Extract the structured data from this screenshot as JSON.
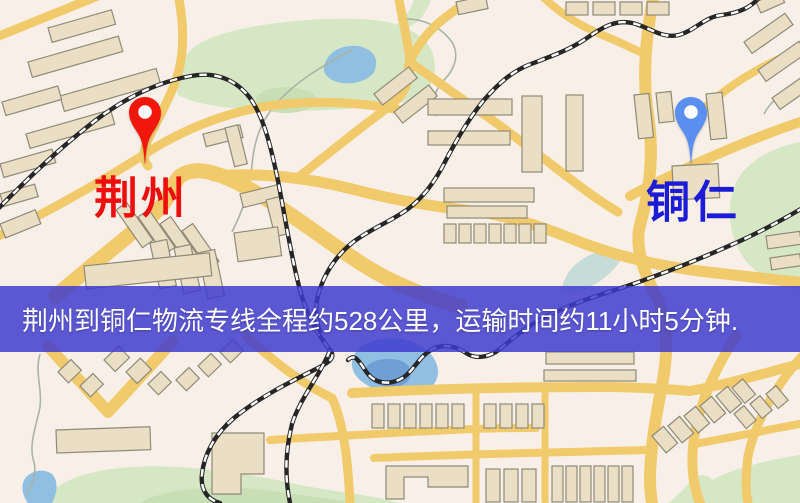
{
  "map": {
    "origin_marker": {
      "city": "荆州",
      "icon": "map-pin-icon",
      "pin_color": "#f2170c",
      "label_color": "#ef0e0e"
    },
    "destination_marker": {
      "city": "铜仁",
      "icon": "map-pin-icon",
      "pin_color": "#5a8ff0",
      "label_color": "#1b1bd8"
    },
    "info_banner": {
      "text": "荆州到铜仁物流专线全程约528公里，运输时间约11小时5分钟.",
      "background_color": "#3e3ace",
      "text_color": "#ffffff"
    },
    "map_colors": {
      "background": "#f8f0e8",
      "road": "#f1ca6b",
      "building": "#eadec5",
      "park": "#d5e7c4",
      "water": "#90bfe2",
      "railway": "#262626"
    }
  }
}
